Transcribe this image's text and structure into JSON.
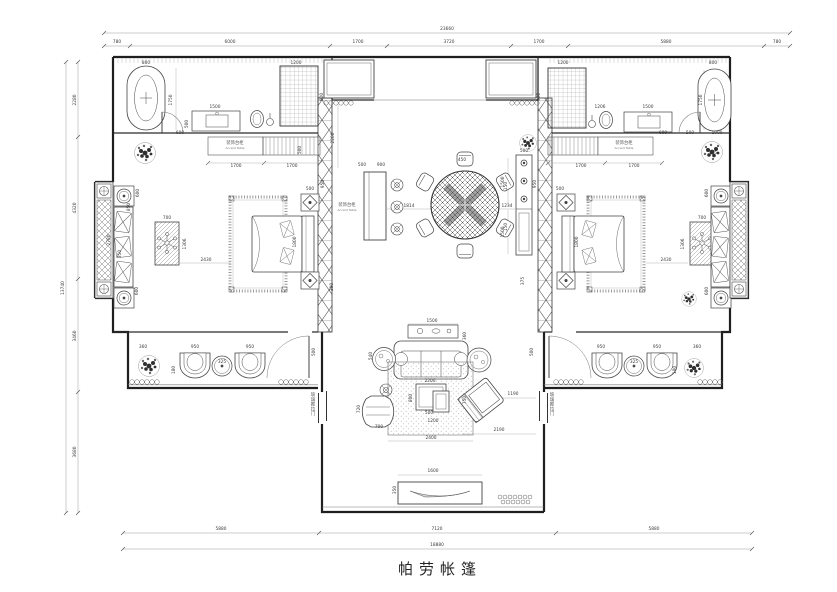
{
  "sheet": {
    "width": 837,
    "height": 592,
    "background": "#ffffff"
  },
  "title_block": {
    "name": "帕劳帐篷"
  },
  "colors": {
    "wall": "#1f1f1f",
    "furniture_line": "#444444",
    "dim_line": "#9a9a9a",
    "dim_text": "#3a3a3a"
  },
  "annotations": [
    {
      "t": "23660",
      "x": 447,
      "y": 30
    },
    {
      "t": "780",
      "x": 117,
      "y": 43
    },
    {
      "t": "6000",
      "x": 230,
      "y": 43
    },
    {
      "t": "1700",
      "x": 358,
      "y": 43
    },
    {
      "t": "3720",
      "x": 449,
      "y": 43
    },
    {
      "t": "1700",
      "x": 539,
      "y": 43
    },
    {
      "t": "5880",
      "x": 666,
      "y": 43
    },
    {
      "t": "780",
      "x": 777,
      "y": 43
    },
    {
      "t": "5880",
      "x": 221,
      "y": 530
    },
    {
      "t": "7120",
      "x": 437,
      "y": 530
    },
    {
      "t": "5880",
      "x": 654,
      "y": 530
    },
    {
      "t": "18880",
      "x": 437,
      "y": 546
    },
    {
      "t": "2280",
      "x": 76,
      "y": 100,
      "r": -90
    },
    {
      "t": "4320",
      "x": 76,
      "y": 208,
      "r": -90
    },
    {
      "t": "3460",
      "x": 76,
      "y": 336,
      "r": -90
    },
    {
      "t": "3680",
      "x": 76,
      "y": 452,
      "r": -90
    },
    {
      "t": "13740",
      "x": 64,
      "y": 288,
      "r": -90
    },
    {
      "t": "800",
      "x": 146,
      "y": 64
    },
    {
      "t": "1750",
      "x": 172,
      "y": 100,
      "r": -90
    },
    {
      "t": "1500",
      "x": 215,
      "y": 108
    },
    {
      "t": "500",
      "x": 188,
      "y": 124,
      "r": -90
    },
    {
      "t": "600",
      "x": 180,
      "y": 134
    },
    {
      "t": "1200",
      "x": 296,
      "y": 64
    },
    {
      "t": "900",
      "x": 323,
      "y": 97,
      "r": -90
    },
    {
      "t": "500",
      "x": 301,
      "y": 150,
      "r": -90
    },
    {
      "t": "装饰台柜",
      "x": 235,
      "y": 144,
      "c": "label"
    },
    {
      "t": "Accent Table",
      "x": 235,
      "y": 149,
      "c": "label-en"
    },
    {
      "t": "1700",
      "x": 236,
      "y": 167
    },
    {
      "t": "1700",
      "x": 292,
      "y": 167
    },
    {
      "t": "600",
      "x": 139,
      "y": 193,
      "r": -90
    },
    {
      "t": "850",
      "x": 130,
      "y": 207,
      "r": -90
    },
    {
      "t": "700",
      "x": 167,
      "y": 219
    },
    {
      "t": "1306",
      "x": 186,
      "y": 244,
      "r": -90
    },
    {
      "t": "350",
      "x": 121,
      "y": 254,
      "r": -90
    },
    {
      "t": "2430",
      "x": 206,
      "y": 261
    },
    {
      "t": "1800",
      "x": 296,
      "y": 242,
      "r": -90
    },
    {
      "t": "950",
      "x": 324,
      "y": 184,
      "r": -90
    },
    {
      "t": "500",
      "x": 310,
      "y": 190
    },
    {
      "t": "300",
      "x": 333,
      "y": 287,
      "r": -90
    },
    {
      "t": "600",
      "x": 138,
      "y": 291,
      "r": -90
    },
    {
      "t": "2780",
      "x": 110,
      "y": 240,
      "r": -90
    },
    {
      "t": "360",
      "x": 143,
      "y": 348
    },
    {
      "t": "950",
      "x": 195,
      "y": 348
    },
    {
      "t": "325",
      "x": 222,
      "y": 363
    },
    {
      "t": "950",
      "x": 250,
      "y": 348
    },
    {
      "t": "180",
      "x": 175,
      "y": 370,
      "r": -90
    },
    {
      "t": "500",
      "x": 315,
      "y": 352,
      "r": -90
    },
    {
      "t": "2200",
      "x": 334,
      "y": 138,
      "r": -90
    },
    {
      "t": "500",
      "x": 362,
      "y": 166
    },
    {
      "t": "900",
      "x": 381,
      "y": 166
    },
    {
      "t": "装饰台柜",
      "x": 347,
      "y": 206,
      "c": "label"
    },
    {
      "t": "Accent Table",
      "x": 347,
      "y": 211,
      "c": "label-en"
    },
    {
      "t": "1814",
      "x": 409,
      "y": 207
    },
    {
      "t": "450",
      "x": 462,
      "y": 161
    },
    {
      "t": "150",
      "x": 507,
      "y": 186,
      "r": -90
    },
    {
      "t": "150",
      "x": 507,
      "y": 227,
      "r": -90
    },
    {
      "t": "1234",
      "x": 507,
      "y": 207
    },
    {
      "t": "500",
      "x": 524,
      "y": 152
    },
    {
      "t": "1500",
      "x": 504,
      "y": 182,
      "r": -90
    },
    {
      "t": "1500",
      "x": 504,
      "y": 232,
      "r": -90
    },
    {
      "t": "375",
      "x": 524,
      "y": 281,
      "r": -90
    },
    {
      "t": "1200",
      "x": 563,
      "y": 64
    },
    {
      "t": "900",
      "x": 540,
      "y": 97,
      "r": -90
    },
    {
      "t": "1206",
      "x": 600,
      "y": 108
    },
    {
      "t": "1500",
      "x": 648,
      "y": 108
    },
    {
      "t": "800",
      "x": 713,
      "y": 64
    },
    {
      "t": "1750",
      "x": 702,
      "y": 100,
      "r": -90
    },
    {
      "t": "600",
      "x": 663,
      "y": 134
    },
    {
      "t": "500",
      "x": 690,
      "y": 134
    },
    {
      "t": "1000",
      "x": 717,
      "y": 134
    },
    {
      "t": "365",
      "x": 713,
      "y": 154
    },
    {
      "t": "装饰台柜",
      "x": 624,
      "y": 144,
      "c": "label"
    },
    {
      "t": "Accent Table",
      "x": 624,
      "y": 149,
      "c": "label-en"
    },
    {
      "t": "1700",
      "x": 581,
      "y": 167
    },
    {
      "t": "1700",
      "x": 634,
      "y": 167
    },
    {
      "t": "500",
      "x": 560,
      "y": 190
    },
    {
      "t": "1800",
      "x": 578,
      "y": 242,
      "r": -90
    },
    {
      "t": "2430",
      "x": 666,
      "y": 261
    },
    {
      "t": "700",
      "x": 702,
      "y": 219
    },
    {
      "t": "1306",
      "x": 684,
      "y": 244,
      "r": -90
    },
    {
      "t": "950",
      "x": 536,
      "y": 184,
      "r": -90
    },
    {
      "t": "600",
      "x": 708,
      "y": 193,
      "r": -90
    },
    {
      "t": "600",
      "x": 708,
      "y": 291,
      "r": -90
    },
    {
      "t": "360",
      "x": 697,
      "y": 348
    },
    {
      "t": "950",
      "x": 601,
      "y": 348
    },
    {
      "t": "325",
      "x": 634,
      "y": 363
    },
    {
      "t": "950",
      "x": 657,
      "y": 348
    },
    {
      "t": "180",
      "x": 676,
      "y": 370,
      "r": -90
    },
    {
      "t": "500",
      "x": 533,
      "y": 352,
      "r": -90
    },
    {
      "t": "1500",
      "x": 432,
      "y": 322
    },
    {
      "t": "360",
      "x": 466,
      "y": 336,
      "r": -90
    },
    {
      "t": "540",
      "x": 372,
      "y": 356,
      "r": -90
    },
    {
      "t": "2200",
      "x": 430,
      "y": 382
    },
    {
      "t": "800",
      "x": 412,
      "y": 398,
      "r": -90
    },
    {
      "t": "500",
      "x": 429,
      "y": 414
    },
    {
      "t": "1200",
      "x": 433,
      "y": 422
    },
    {
      "t": "720",
      "x": 360,
      "y": 409,
      "r": -90
    },
    {
      "t": "700",
      "x": 379,
      "y": 428
    },
    {
      "t": "2400",
      "x": 431,
      "y": 439
    },
    {
      "t": "750",
      "x": 466,
      "y": 400,
      "r": -90
    },
    {
      "t": "1190",
      "x": 513,
      "y": 395
    },
    {
      "t": "2190",
      "x": 499,
      "y": 431
    },
    {
      "t": "1600",
      "x": 433,
      "y": 472
    },
    {
      "t": "350",
      "x": 396,
      "y": 490,
      "r": -90
    },
    {
      "t": "玻璃推拉门",
      "x": 313,
      "y": 396,
      "c": "vtext"
    },
    {
      "t": "玻璃推拉门",
      "x": 552,
      "y": 396,
      "c": "vtext"
    }
  ]
}
